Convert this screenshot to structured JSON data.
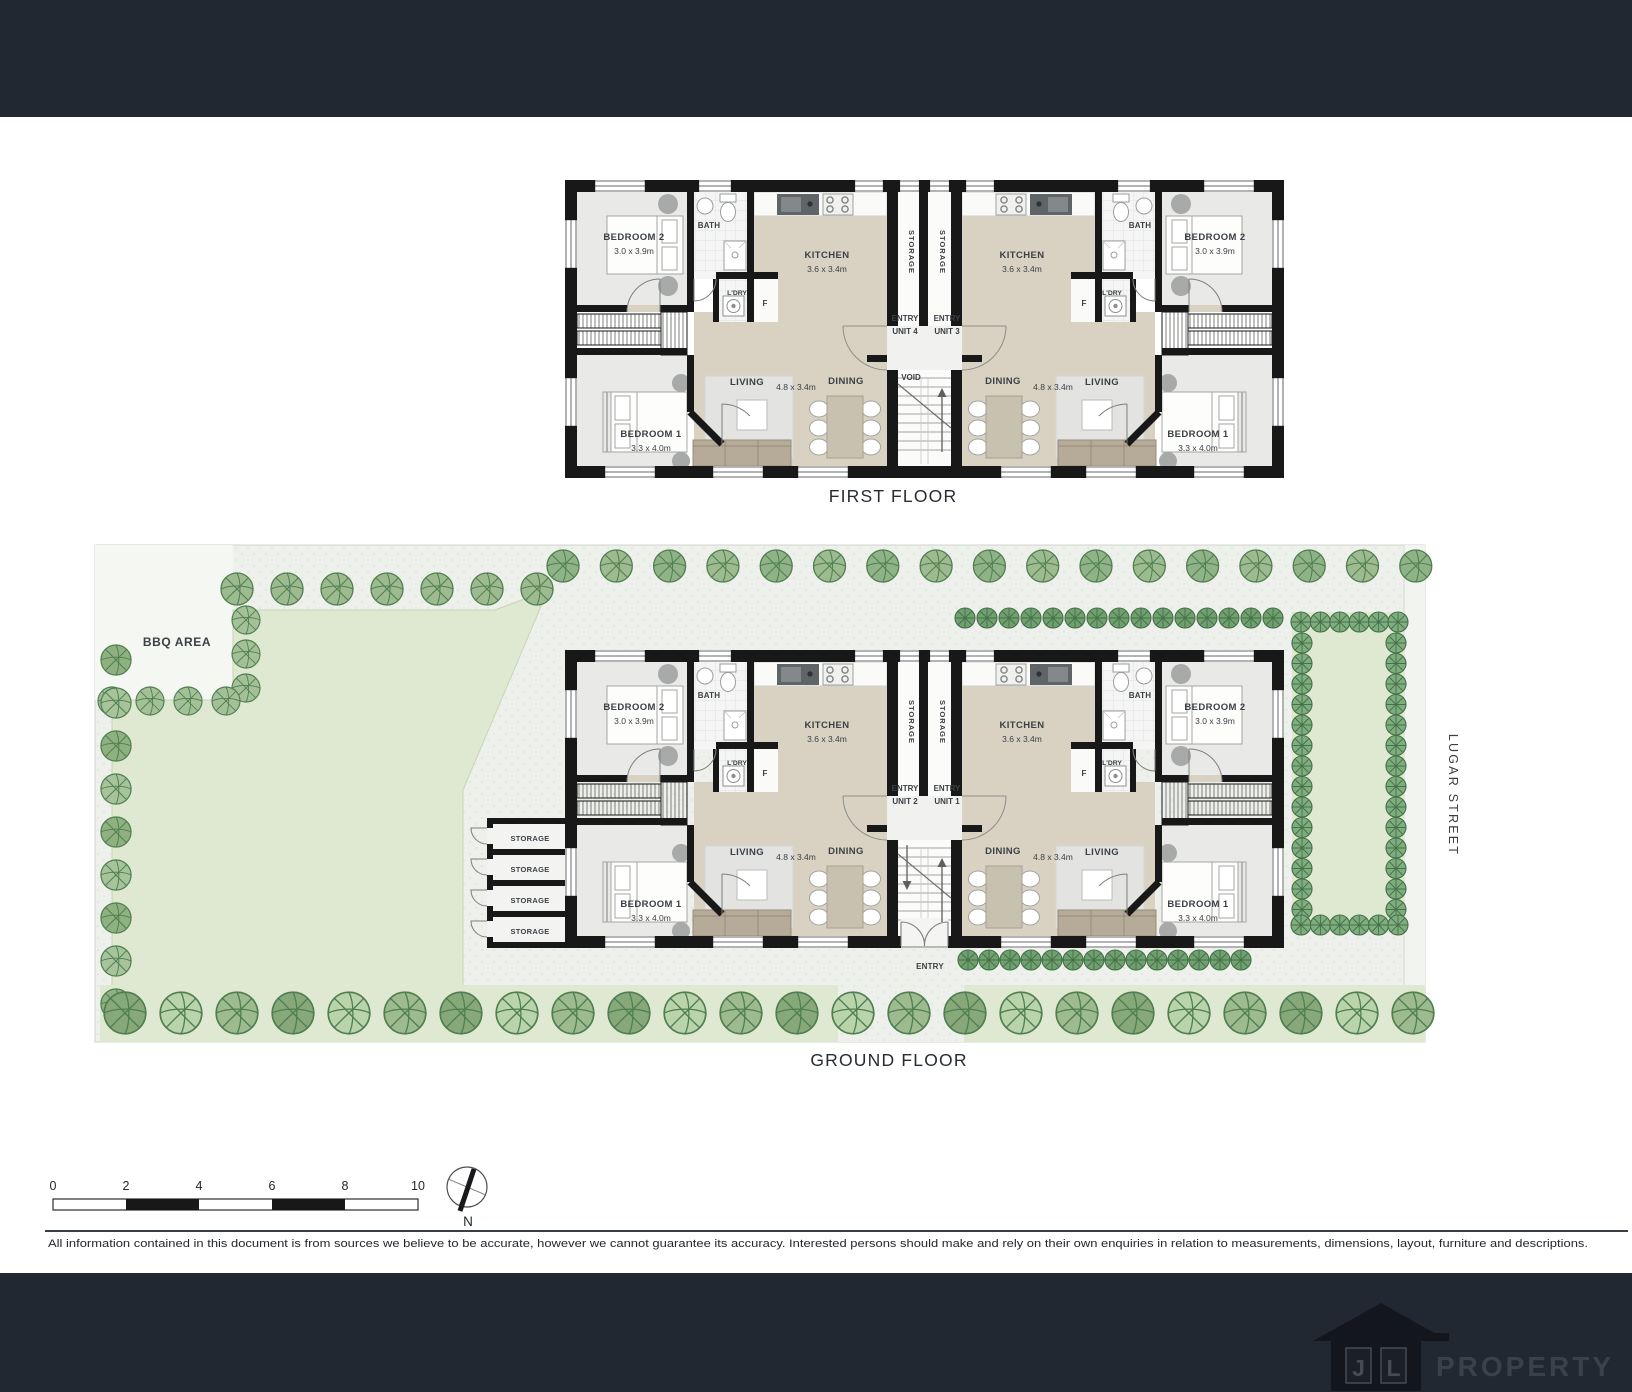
{
  "plan": {
    "rooms": {
      "bedroom2": {
        "name": "BEDROOM 2",
        "dim": "3.0 x 3.9m"
      },
      "bedroom1": {
        "name": "BEDROOM 1",
        "dim": "3.3 x 4.0m"
      },
      "kitchen": {
        "name": "KITCHEN",
        "dim": "3.6 x 3.4m"
      },
      "living": {
        "name": "LIVING"
      },
      "dining": {
        "name": "DINING"
      },
      "living_dining_dim": "4.8 x 3.4m",
      "bath": "BATH",
      "laundry": "L'DRY",
      "fridge": "F",
      "storage": "STORAGE",
      "void": "VOID",
      "entry": "ENTRY"
    },
    "units": {
      "unit1": "UNIT 1",
      "unit2": "UNIT 2",
      "unit3": "UNIT 3",
      "unit4": "UNIT 4"
    }
  },
  "first_floor": {
    "title": "FIRST FLOOR"
  },
  "ground_floor": {
    "title": "GROUND FLOOR",
    "bbq_area": "BBQ AREA",
    "street_name": "LUGAR STREET"
  },
  "scale_bar": {
    "ticks": [
      "0",
      "2",
      "4",
      "6",
      "8",
      "10"
    ]
  },
  "compass": {
    "north": "N"
  },
  "disclaimer": "All information contained in this document is from sources we believe to be accurate, however we cannot guarantee its accuracy. Interested persons should make and rely on their own enquiries in relation to measurements, dimensions, layout, furniture and descriptions.",
  "footer_logo": {
    "letter_j": "J",
    "letter_l": "L",
    "brand": "PROPERTY"
  },
  "colors": {
    "bar": "#222831",
    "wall": "#181818",
    "lawn": "#dfe8d0",
    "beige": "#d9d2c3"
  }
}
